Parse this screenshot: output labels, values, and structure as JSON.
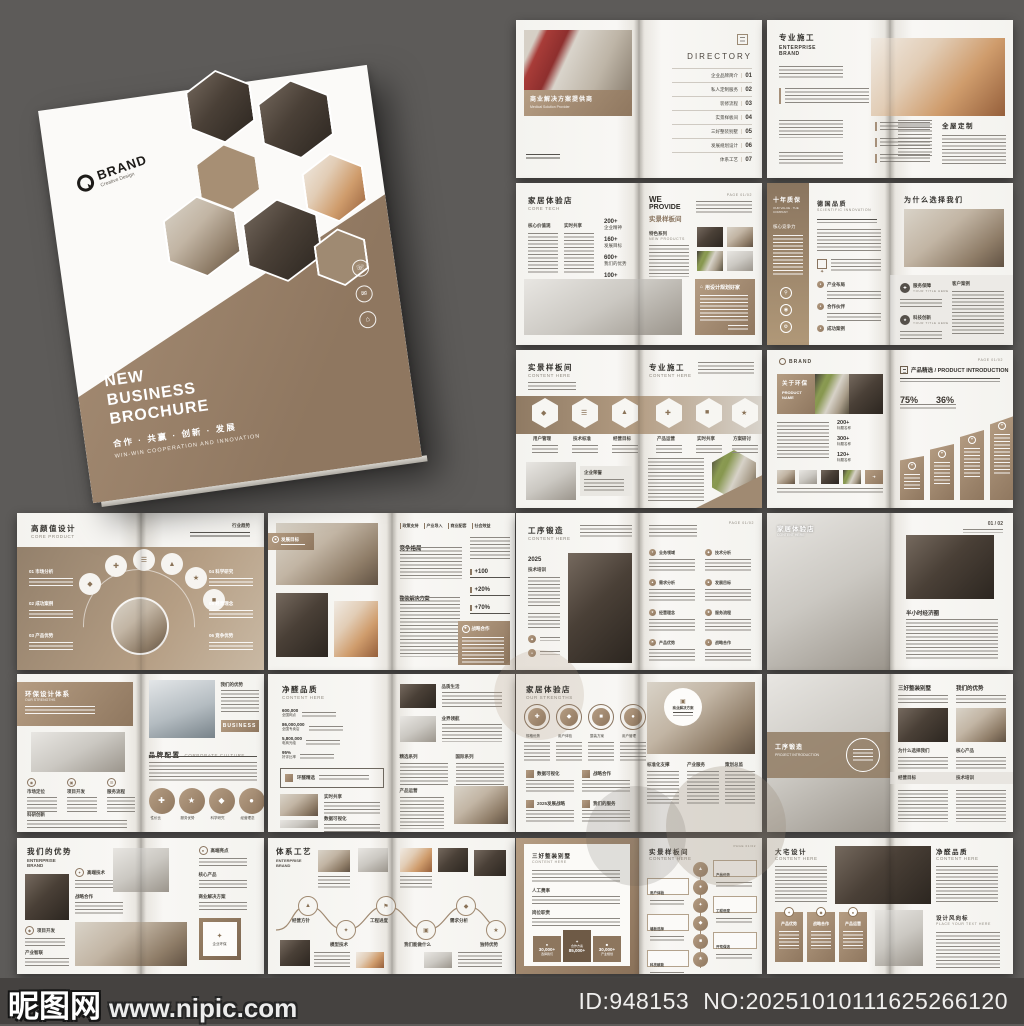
{
  "watermark": {
    "site": "昵图网",
    "url": "www.nipic.com"
  },
  "footer": {
    "id": "ID:948153",
    "no": "NO:20251010111625266120"
  },
  "cover": {
    "brand": "BRAND",
    "brand_sub": "Creative Design",
    "title_l1": "NEW",
    "title_l2": "BUSINESS",
    "title_l3": "BROCHURE",
    "tagline_zh": "合作 · 共赢 · 创新 · 发展",
    "tagline_en": "WIN-WIN COOPERATION AND INNOVATION"
  },
  "s1": {
    "caption_zh": "商业解决方案提供商",
    "caption_en": "Medical Solution Provider",
    "dir_title": "DIRECTORY",
    "items": [
      {
        "label": "企业品牌简介",
        "num": "01"
      },
      {
        "label": "私人定制服务",
        "num": "02"
      },
      {
        "label": "装修流程",
        "num": "03"
      },
      {
        "label": "实景样板间",
        "num": "04"
      },
      {
        "label": "三好整装别墅",
        "num": "05"
      },
      {
        "label": "发展规划设计",
        "num": "06"
      },
      {
        "label": "体系工艺",
        "num": "07"
      }
    ]
  },
  "s2": {
    "title_zh": "专业施工",
    "title_en1": "ENTERPRISE",
    "title_en2": "BRAND",
    "right_title": "全屋定制"
  },
  "s3": {
    "title_zh": "家居体验店",
    "title_en": "CORE TECH",
    "col1": "核心价值观",
    "col2": "实时共享",
    "stats": [
      {
        "v": "200+",
        "l": "企业精神"
      },
      {
        "v": "160+",
        "l": "发展目标"
      },
      {
        "v": "600+",
        "l": "我们的优势"
      },
      {
        "v": "100+",
        "l": "业务范围"
      }
    ],
    "we1": "WE",
    "we2": "PROVIDE",
    "we3": "实景样板间",
    "feat": "特色系列",
    "feat_en": "NEW PRODUCTS",
    "page": "PAGE 01/02",
    "banner": "用设计规划好家"
  },
  "s4": {
    "side_zh": "十年质保",
    "side_en": "OUR VALUE · THE COMPANY",
    "side_sub": "核心竞争力",
    "mid_zh": "德国品质",
    "mid_en": "SCIENTIFIC INNOVATION",
    "bullets": [
      "产业布局",
      "合作伙伴",
      "成功案例"
    ],
    "right_title": "为什么选择我们",
    "it1": "服务保障",
    "it1_en": "YOUR TITLE HERE",
    "it2": "科技创新",
    "it2_en": "YOUR TITLE HERE",
    "it3": "客户案例"
  },
  "s5": {
    "lt_zh": "实景样板间",
    "lt_en": "CONTENT HERE",
    "rt_zh": "专业施工",
    "rt_en": "CONTENT HERE",
    "hex": [
      "用户管理",
      "技术标准",
      "经营目标",
      "产品运营",
      "实时共享",
      "方案研讨"
    ],
    "box": "企业荣誉"
  },
  "s6": {
    "brand": "BRAND",
    "page": "PAGE 01/02",
    "banner_zh": "关于环保",
    "banner_en1": "PRODUCT",
    "banner_en2": "NAME",
    "stats": [
      {
        "v": "200+",
        "l": "标题名称"
      },
      {
        "v": "300+",
        "l": "标题名称"
      },
      {
        "v": "120+",
        "l": "标题名称"
      }
    ],
    "right_title": "产品精选 / PRODUCT INTRODUCTION",
    "p1": "75%",
    "p2": "36%"
  },
  "s7": {
    "title_zh": "高颜值设计",
    "title_en": "CORE PRODUCT",
    "tr": "行业趋势",
    "left_items": [
      "01 市场分析",
      "02 成功案例",
      "03 产品优势"
    ],
    "right_items": [
      "04 科学研究",
      "05 经营理念",
      "06 竞争优势"
    ]
  },
  "s8": {
    "badge": "发展目标",
    "tabs": [
      "政策支持",
      "产业导入",
      "商业配套",
      "社会效益"
    ],
    "h1": "竞争格局",
    "stats": [
      "+100",
      "+20%",
      "+70%"
    ],
    "h2": "整装解决方案",
    "box": "战略合作"
  },
  "s9": {
    "title_zh": "工序锻造",
    "title_en": "CONTENT HERE",
    "year": "2025",
    "side": "技术培训",
    "page": "PAGE 01/02",
    "items": [
      "业务领域",
      "技术分析",
      "需求分析",
      "发展目标",
      "经营理念",
      "服务流程",
      "产品优势",
      "战略合作"
    ]
  },
  "s10": {
    "title_zh": "家居体验店",
    "title_en": "CONTENT HERE",
    "page": "01 / 02",
    "h": "半小时经济圈"
  },
  "s11": {
    "title_zh": "环保设计体系",
    "title_en": "OUR STRENGTHS",
    "cols": [
      "市场定位",
      "项目开发",
      "服务流程"
    ],
    "h2": "科研创新",
    "rt": "我们的优势",
    "btn": "BUSINESS",
    "h3_zh": "品牌配置",
    "h3_en": "CORPORATE CULTURE",
    "circles": [
      "性价比",
      "服务优势",
      "科学研究",
      "经营理念"
    ]
  },
  "s12": {
    "title_zh": "净醛品质",
    "title_en": "CONTENT HERE",
    "stats": [
      {
        "v": "600,000",
        "l": "全国网点"
      },
      {
        "v": "86,000,000",
        "l": "全国专卖店"
      },
      {
        "v": "5,800,000",
        "l": "电商光临"
      },
      {
        "v": "95%",
        "l": "好评比率"
      }
    ],
    "box": "环醛精选",
    "li1": "实时共享",
    "li2": "数据可视化",
    "ri1": "品质生活",
    "ri2": "业界领航",
    "rc1": "精选系列",
    "rc2": "国际系列",
    "rc3": "产品运营"
  },
  "s13": {
    "title_zh": "家居体验店",
    "title_en": "OUR STRENGTHS",
    "circles": [
      "规格优势",
      "用户体验",
      "整装方案",
      "用户管理"
    ],
    "grid": [
      "数据可视化",
      "战略合作",
      "2025发展战略",
      "我们的服务"
    ],
    "badge": "商业解决方案",
    "cols": [
      "标准化支撑",
      "产业服务",
      "策划总监"
    ]
  },
  "s14": {
    "band_zh": "工序锻造",
    "band_en": "PROJECT INTRODUCTION",
    "rt1": "三好整装别墅",
    "rt2": "我们的优势",
    "c1": "为什么选择我们",
    "c2": "核心产品",
    "c3": "经营目标",
    "c4": "技术培训"
  },
  "s15": {
    "title_zh": "我们的优势",
    "title_en1": "ENTERPRISE",
    "title_en2": "BRAND",
    "m1": "高端技术",
    "m2": "战略合作",
    "m3": "项目开发",
    "m4": "产业智联",
    "r1": "高端亮点",
    "r2": "核心产品",
    "r3": "商业解决方案",
    "badge": "企业环保"
  },
  "s16": {
    "title_zh": "体系工艺",
    "title_en1": "ENTERPRISE",
    "title_en2": "BRAND",
    "nodes": [
      "经营方针",
      "模型技术",
      "工程进度",
      "我们能做什么",
      "需求分析",
      "独特优势"
    ]
  },
  "s17": {
    "lt_zh": "三好整装别墅",
    "lt_en": "CONTENT HERE",
    "sub1": "人工费率",
    "sub2": "岗位职责",
    "tiles": [
      {
        "v": "30,000+",
        "l": "选择我们"
      },
      {
        "v": "85,000+",
        "l": "合作方案"
      },
      {
        "v": "30,000+",
        "l": "产业规划"
      }
    ],
    "rt_zh": "实景样板间",
    "rt_en": "CONTENT HERE",
    "page": "PAGE 01/02",
    "steps": [
      "产品优势",
      "用户体验",
      "工程进度",
      "墙板选择",
      "开荒保洁",
      "科技赋能"
    ]
  },
  "s18": {
    "lt_zh": "大宅设计",
    "lt_en": "CONTENT HERE",
    "rt_zh": "净醛品质",
    "rt_en": "CONTENT HERE",
    "tiles": [
      "产品优势",
      "战略合作",
      "产品运营"
    ],
    "h_zh": "设计风向标",
    "h_en": "PLACE YOUR TEXT HERE"
  }
}
